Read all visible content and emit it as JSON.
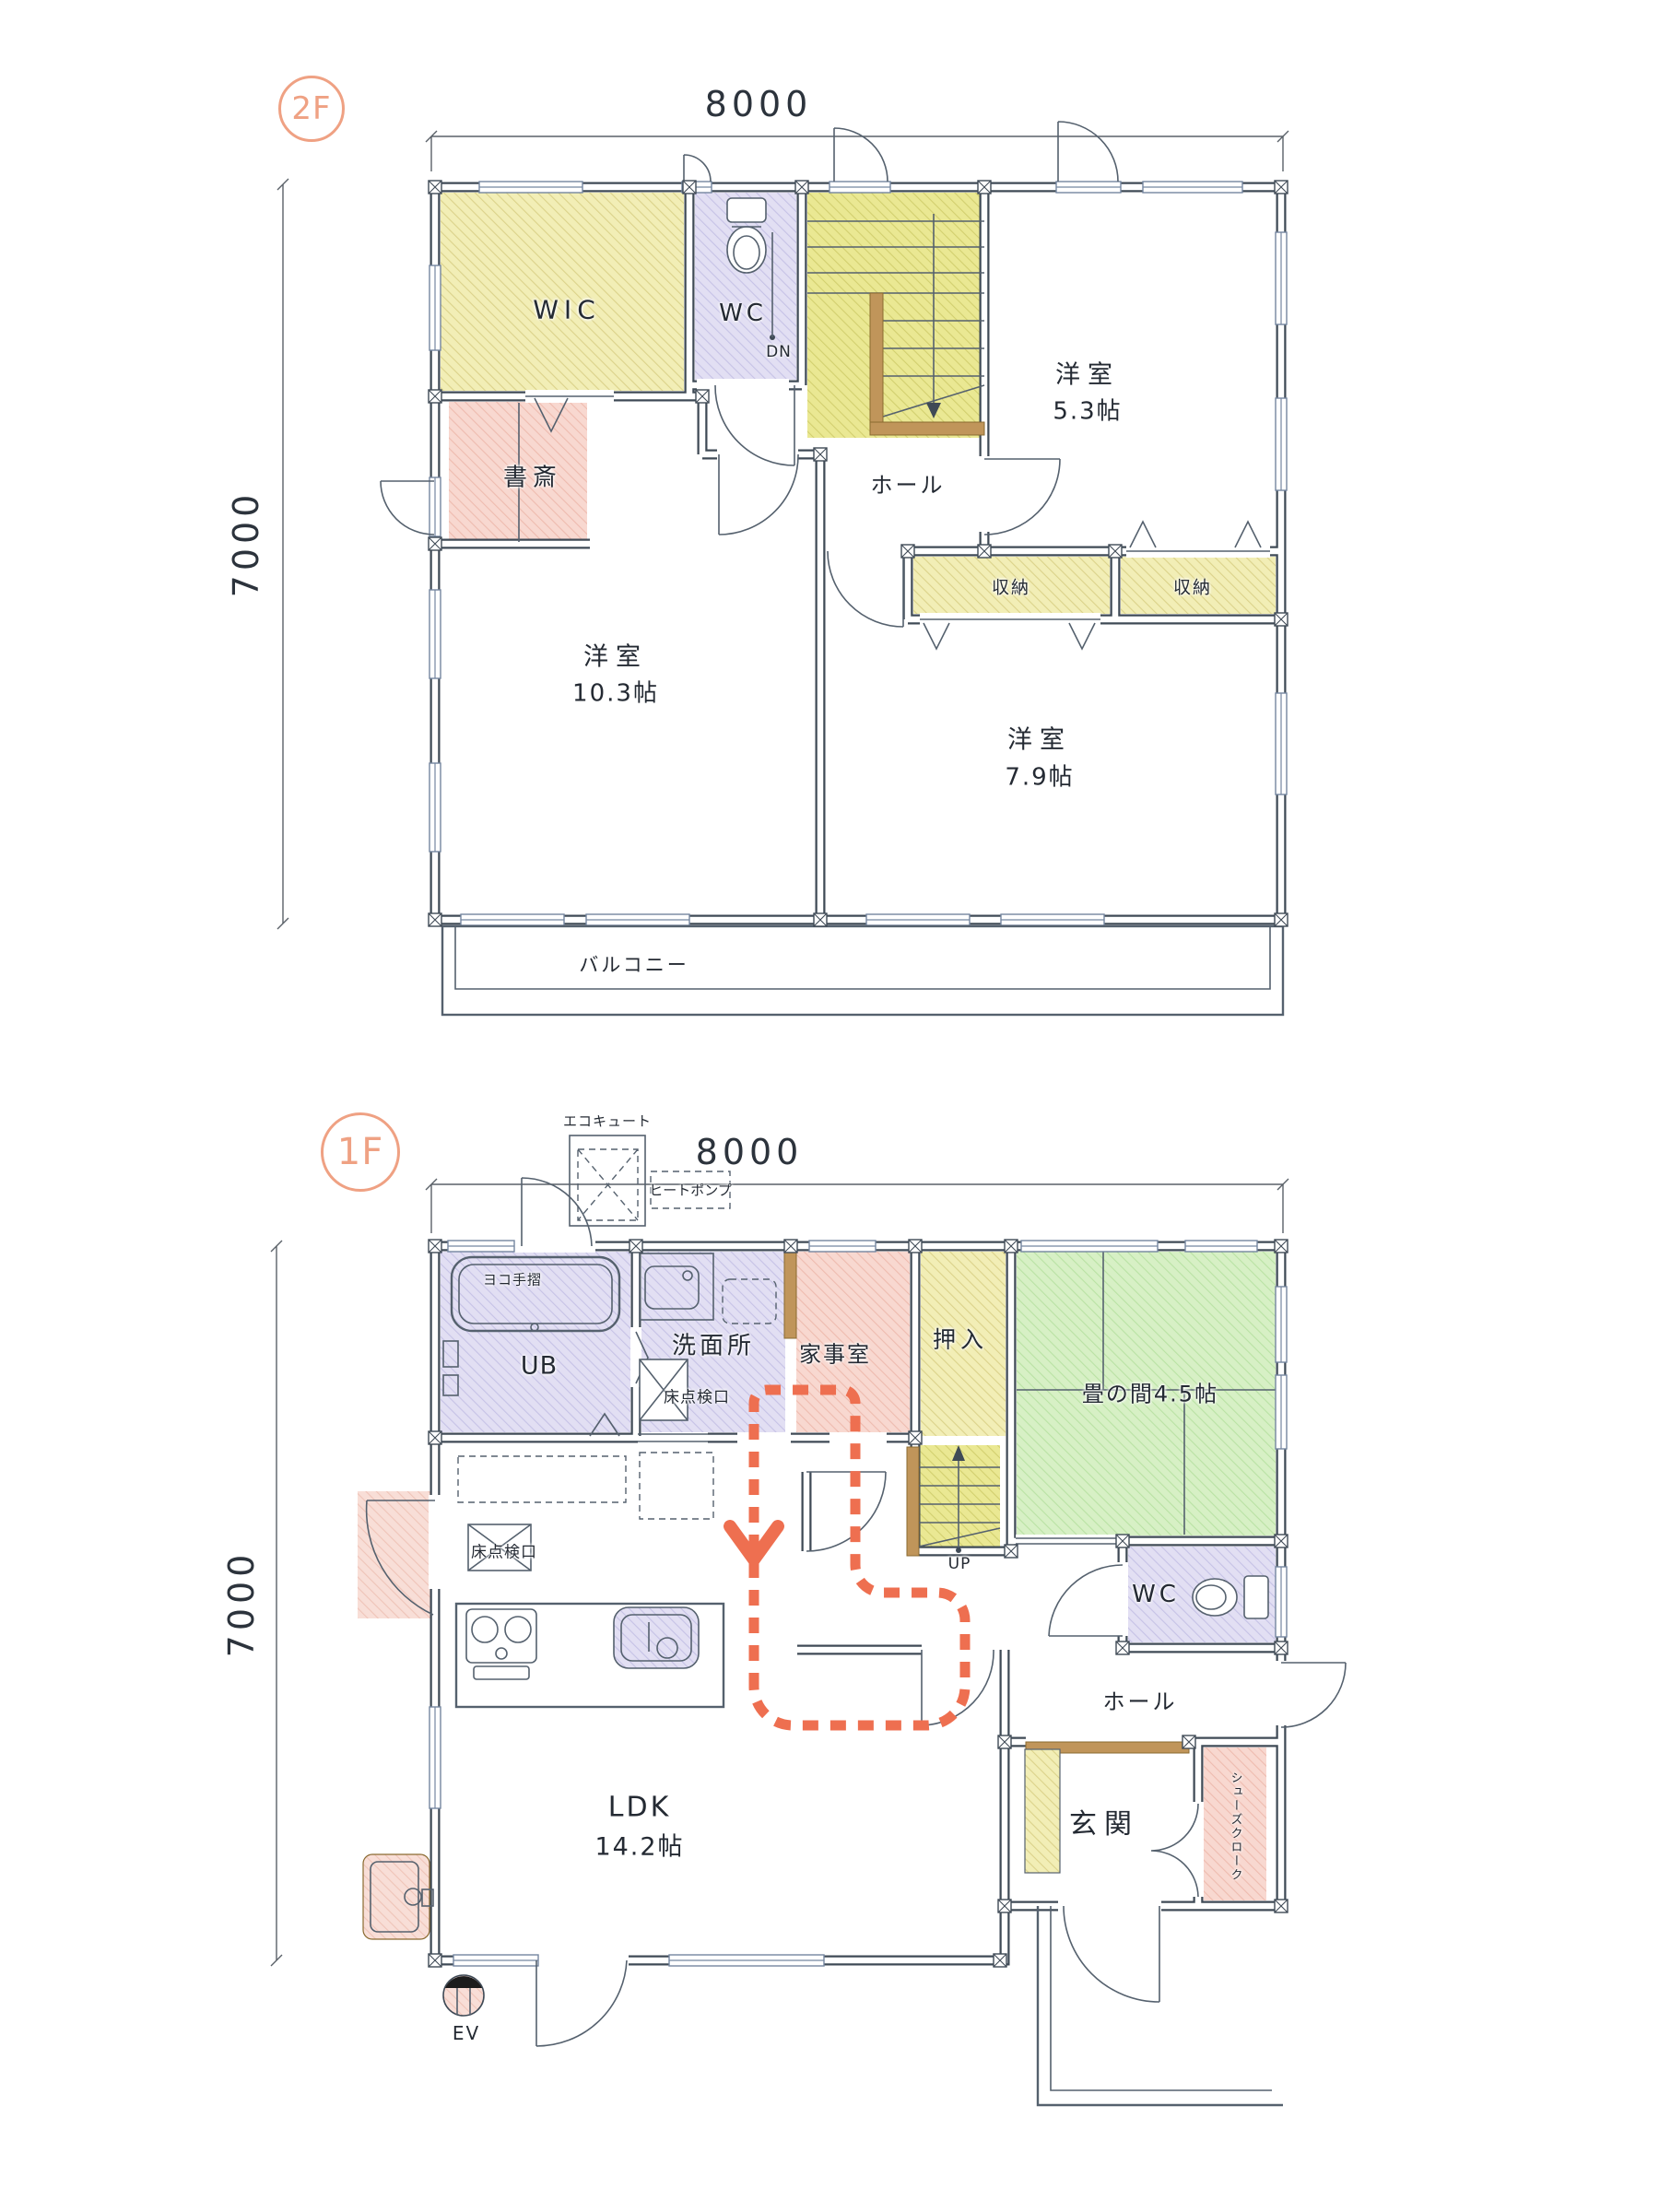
{
  "colors": {
    "wall": "#3f4a56",
    "badge_orange": "#efa183",
    "route_red": "#ee6f50",
    "hatch_yellow": "#f2eeb6",
    "hatch_stair_yellow": "#eae893",
    "hatch_lavender": "#e2dff3",
    "hatch_pink": "#f8d8d0",
    "hatch_green": "#d7f0c5",
    "brown": "#c0955a"
  },
  "floor2": {
    "badge": "2F",
    "dim_width": "8000",
    "dim_height": "7000",
    "labels": {
      "wic": "WIC",
      "wc": "WC",
      "dn": "DN",
      "hall": "ホール",
      "room53_name": "洋室",
      "room53_size": "5.3帖",
      "study": "書斎",
      "room103_name": "洋室",
      "room103_size": "10.3帖",
      "storage1": "収納",
      "storage2": "収納",
      "room79_name": "洋室",
      "room79_size": "7.9帖",
      "balcony": "バルコニー"
    }
  },
  "floor1": {
    "badge": "1F",
    "dim_width": "8000",
    "dim_height": "7000",
    "labels": {
      "ecocute": "エコキュート",
      "heatpump": "ヒートポンプ",
      "grab_bar": "ヨコ手摺",
      "ub": "UB",
      "washroom": "洗面所",
      "floor_hatch_washroom": "床点検口",
      "utility_room": "家事室",
      "oshiire": "押入",
      "tatami_room": "畳の間4.5帖",
      "up": "UP",
      "wc": "WC",
      "hall": "ホール",
      "floor_hatch_kitchen": "床点検口",
      "ldk_name": "LDK",
      "ldk_size": "14.2帖",
      "entrance": "玄関",
      "shoes_cloak": "シューズクローク",
      "ev": "EV"
    }
  }
}
